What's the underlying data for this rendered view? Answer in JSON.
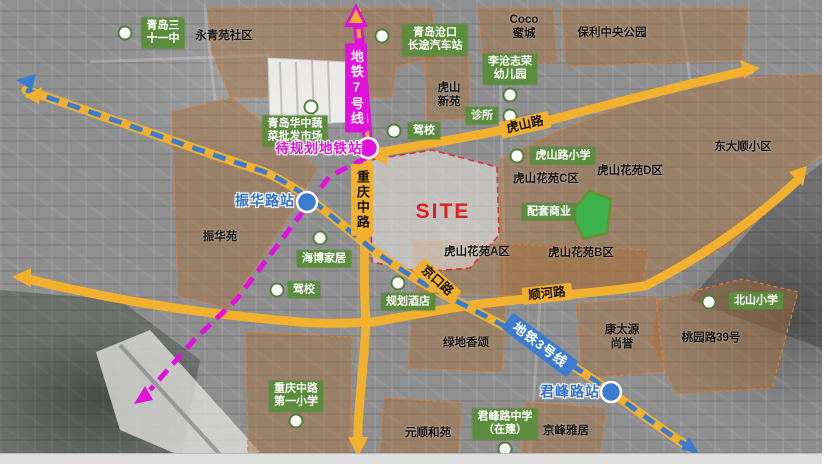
{
  "map": {
    "site_label": "SITE",
    "colors": {
      "road_yellow": "#f2b02f",
      "metro7_magenta": "#e111dc",
      "metro3_blue": "#3c7cd0",
      "poi_green": "#5c8c3e",
      "park_green": "#3db14a",
      "site_red": "#e02020",
      "zone_brown": "rgba(166,110,58,0.45)",
      "zone_border_orange": "#e07a30"
    },
    "metro_labels": {
      "line7": "地铁7号线",
      "line3": "地铁3号线"
    },
    "road_labels": {
      "chongqing": "重庆中路",
      "hushan": "虎山路",
      "jingkou": "京口路",
      "shunhe": "顺河路"
    },
    "stations": {
      "planned": "待规划地铁站",
      "zhenhua": "振华路站",
      "junfeng": "君峰路站"
    },
    "green_pois": [
      {
        "text": "青岛三\n十一中"
      },
      {
        "text": "青岛沧口\n长途汽车站"
      },
      {
        "text": "李沧志荣\n幼儿园"
      },
      {
        "text": "诊所"
      },
      {
        "text": "驾校"
      },
      {
        "text": "青岛华中蔬\n菜批发市场"
      },
      {
        "text": "虎山路小学"
      },
      {
        "text": "配套商业"
      },
      {
        "text": "海博家居"
      },
      {
        "text": "驾校"
      },
      {
        "text": "规划酒店"
      },
      {
        "text": "北山小学"
      },
      {
        "text": "重庆中路\n第一小学"
      },
      {
        "text": "君峰路中学\n（在建）"
      }
    ],
    "area_labels": [
      {
        "text": "永青苑社区"
      },
      {
        "text": "Coco\n蜜城"
      },
      {
        "text": "保利中央公园"
      },
      {
        "text": "虎山\n新苑"
      },
      {
        "text": "虎山花苑C区"
      },
      {
        "text": "虎山花苑D区"
      },
      {
        "text": "东大顺小区"
      },
      {
        "text": "振华苑"
      },
      {
        "text": "虎山花苑A区"
      },
      {
        "text": "虎山花苑B区"
      },
      {
        "text": "绿地香颂"
      },
      {
        "text": "康太源\n尚誉"
      },
      {
        "text": "桃园路39号"
      },
      {
        "text": "元顺和苑"
      },
      {
        "text": "京峰雅居"
      }
    ]
  }
}
